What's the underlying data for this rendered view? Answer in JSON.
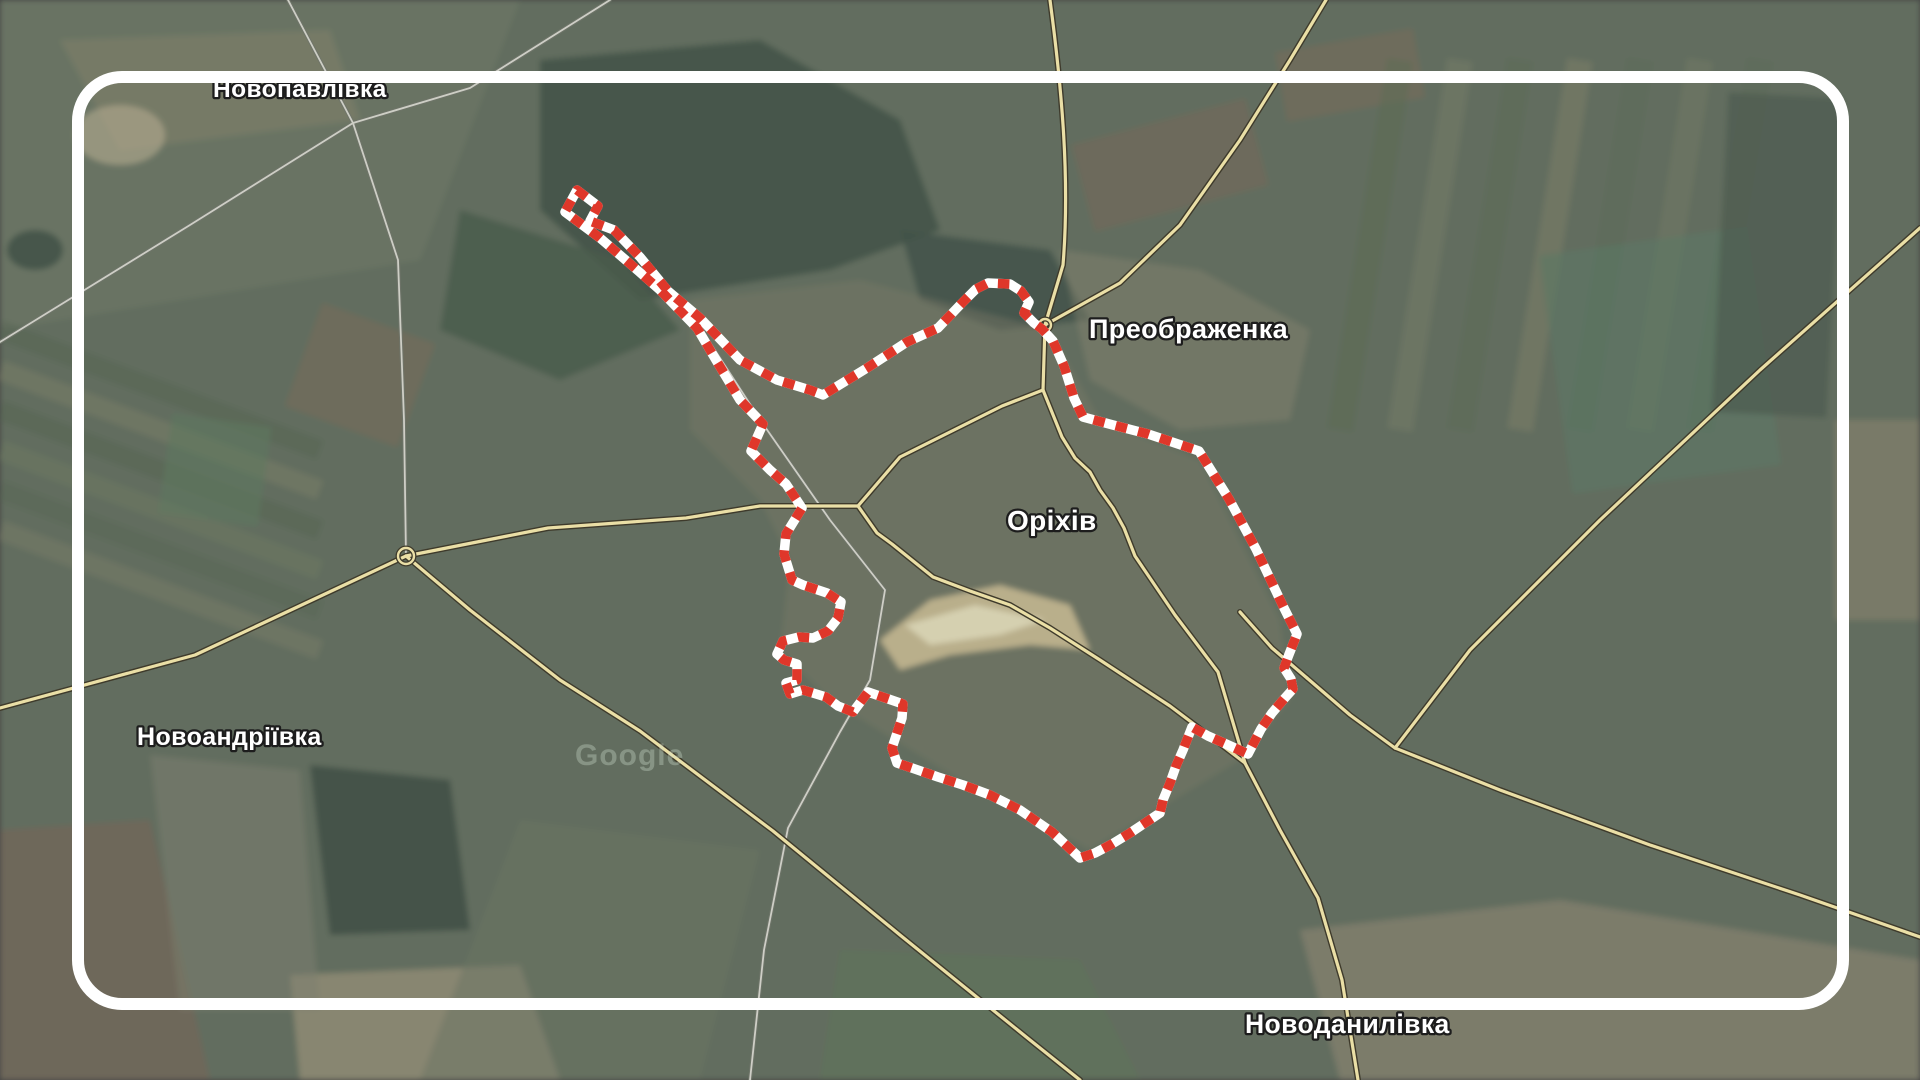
{
  "map": {
    "labels": [
      {
        "id": "novopavlivka",
        "text": "Новопавлівка"
      },
      {
        "id": "preobrazhenka",
        "text": "Преображенка"
      },
      {
        "id": "orikhiv",
        "text": "Оріхів"
      },
      {
        "id": "novoandriivka",
        "text": "Новоандріївка"
      },
      {
        "id": "novodanylivka",
        "text": "Новоданилівка"
      }
    ],
    "watermark": "Google",
    "colors": {
      "boundary_red": "#df372a",
      "boundary_white": "#ffffff",
      "road_fill": "#eadfa6",
      "road_casing": "#3e3a2b",
      "minor_road": "#d8d8d0",
      "frame": "#ffffff",
      "label_fill": "#ffffff",
      "label_outline": "#1d1d1d"
    }
  }
}
